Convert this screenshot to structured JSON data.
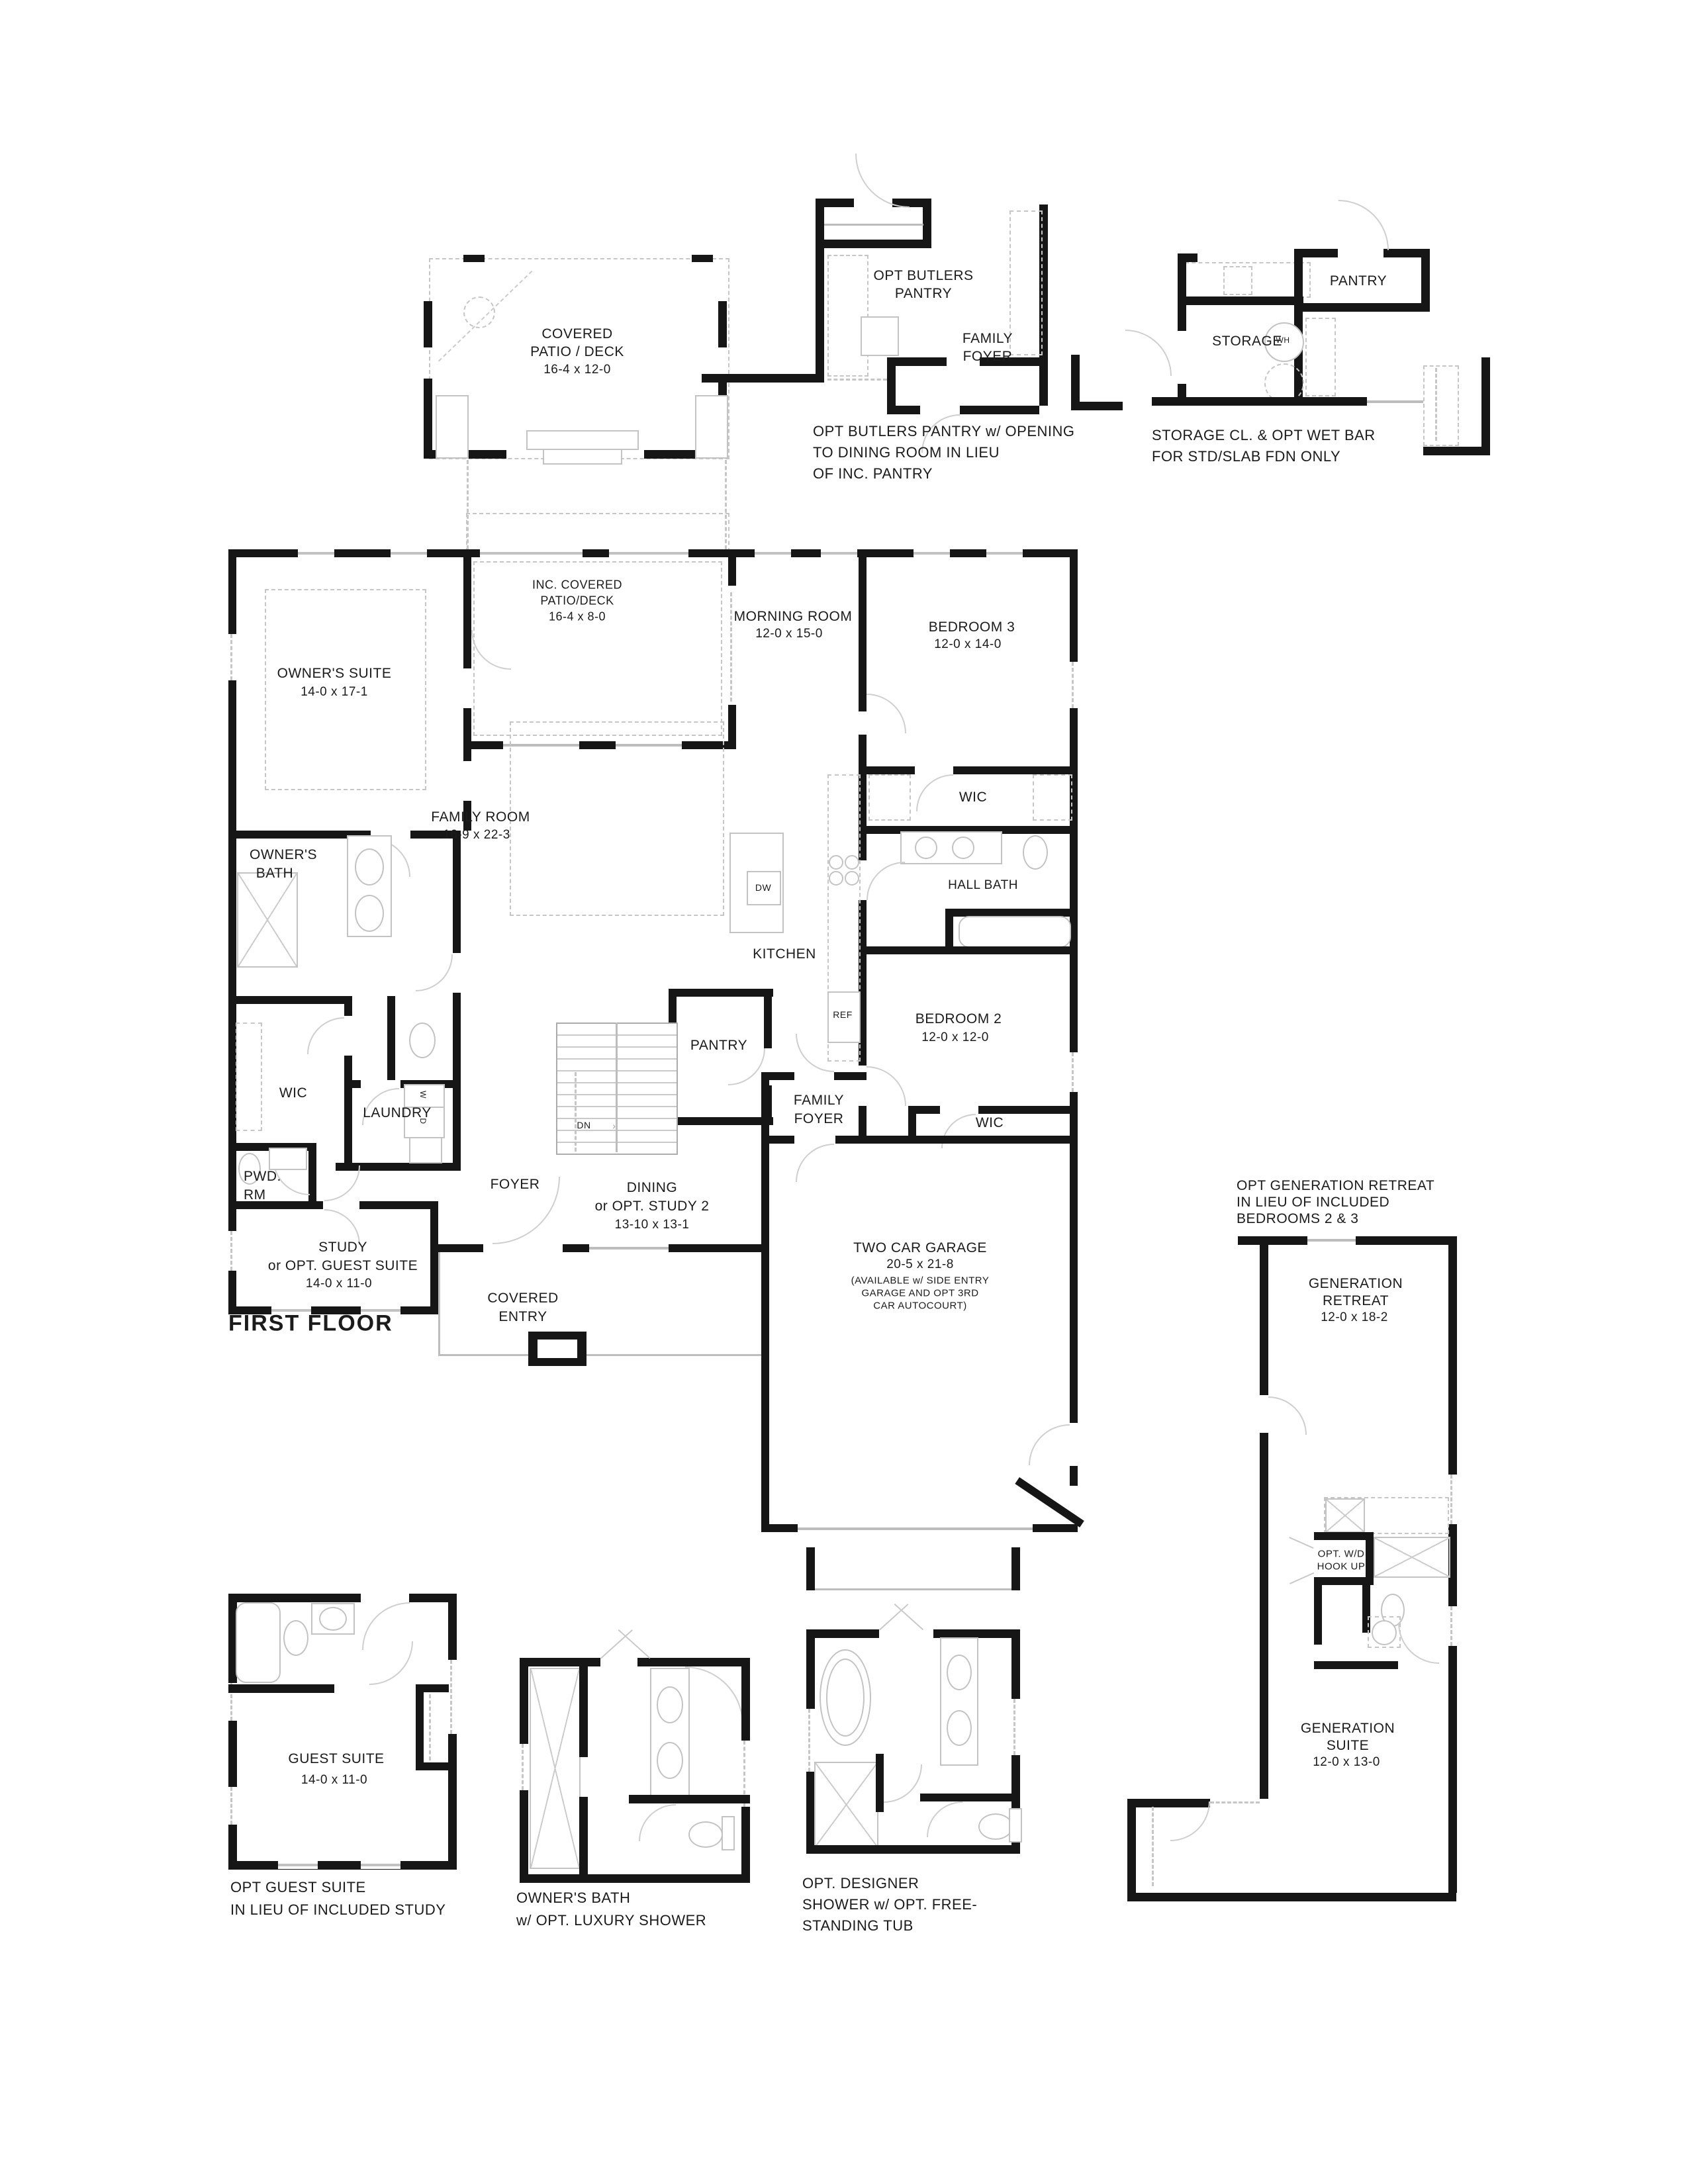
{
  "sheet": {
    "title": "FIRST FLOOR"
  },
  "rooms": {
    "owners_suite": {
      "name": "OWNER'S SUITE",
      "dims": "14-0 x 17-1"
    },
    "inc_patio": {
      "line1": "INC. COVERED",
      "line2": "PATIO/DECK",
      "dims": "16-4 x 8-0"
    },
    "morning": {
      "name": "MORNING ROOM",
      "dims": "12-0 x 15-0"
    },
    "bedroom3": {
      "name": "BEDROOM 3",
      "dims": "12-0 x 14-0"
    },
    "family_room": {
      "name": "FAMILY ROOM",
      "dims": "16-9 x 22-3"
    },
    "wic_bed3": "WIC",
    "hall_bath": "HALL BATH",
    "kitchen": "KITCHEN",
    "bedroom2": {
      "name": "BEDROOM 2",
      "dims": "12-0 x 12-0"
    },
    "pantry": "PANTRY",
    "family_foyer": {
      "line1": "FAMILY",
      "line2": "FOYER"
    },
    "wic_bed2": "WIC",
    "owners_bath": {
      "line1": "OWNER'S",
      "line2": "BATH"
    },
    "wic_owner": "WIC",
    "laundry": "LAUNDRY",
    "pwd": {
      "line1": "PWD.",
      "line2": "RM"
    },
    "foyer": "FOYER",
    "dining": {
      "line1": "DINING",
      "line2": "or OPT. STUDY 2",
      "dims": "13-10 x 13-1"
    },
    "study": {
      "line1": "STUDY",
      "line2": "or OPT. GUEST SUITE",
      "dims": "14-0 x 11-0"
    },
    "covered_entry": {
      "line1": "COVERED",
      "line2": "ENTRY"
    },
    "garage": {
      "name": "TWO CAR GARAGE",
      "dims": "20-5 x 21-8",
      "note1": "(AVAILABLE w/ SIDE ENTRY",
      "note2": "GARAGE AND OPT 3RD",
      "note3": "CAR AUTOCOURT)"
    }
  },
  "appliances": {
    "dw": "DW",
    "ref": "REF",
    "washer": "W",
    "dryer": "D",
    "down": "DN",
    "down_arrow": "›"
  },
  "details": {
    "covered_patio": {
      "line1": "COVERED",
      "line2": "PATIO / DECK",
      "dims": "16-4 x 12-0"
    },
    "butlers": {
      "room": {
        "line1": "OPT BUTLERS",
        "line2": "PANTRY"
      },
      "family_foyer": {
        "line1": "FAMILY",
        "line2": "FOYER"
      },
      "caption": {
        "line1": "OPT BUTLERS PANTRY w/ OPENING",
        "line2": "TO DINING ROOM IN LIEU",
        "line3": "OF INC. PANTRY"
      }
    },
    "storage": {
      "pantry": "PANTRY",
      "storage": "STORAGE",
      "water_heater": "WH",
      "caption": {
        "line1": "STORAGE CL. & OPT WET BAR",
        "line2": "FOR STD/SLAB FDN ONLY"
      }
    },
    "generation": {
      "caption": {
        "line1": "OPT GENERATION RETREAT",
        "line2": "IN LIEU OF INCLUDED",
        "line3": "BEDROOMS 2 & 3"
      },
      "retreat": {
        "line1": "GENERATION",
        "line2": "RETREAT",
        "dims": "12-0 x 18-2"
      },
      "wd": {
        "line1": "OPT. W/D",
        "line2": "HOOK UP"
      },
      "suite": {
        "line1": "GENERATION",
        "line2": "SUITE",
        "dims": "12-0 x 13-0"
      }
    },
    "guest": {
      "room": "GUEST SUITE",
      "dims": "14-0 x 11-0",
      "caption": {
        "line1": "OPT GUEST SUITE",
        "line2": "IN LIEU OF INCLUDED STUDY"
      }
    },
    "owners_bath_opt": {
      "caption": {
        "line1": "OWNER'S BATH",
        "line2": "w/ OPT. LUXURY SHOWER"
      }
    },
    "designer_shower": {
      "caption": {
        "line1": "OPT. DESIGNER",
        "line2": "SHOWER w/ OPT. FREE-",
        "line3": "STANDING TUB"
      }
    }
  }
}
